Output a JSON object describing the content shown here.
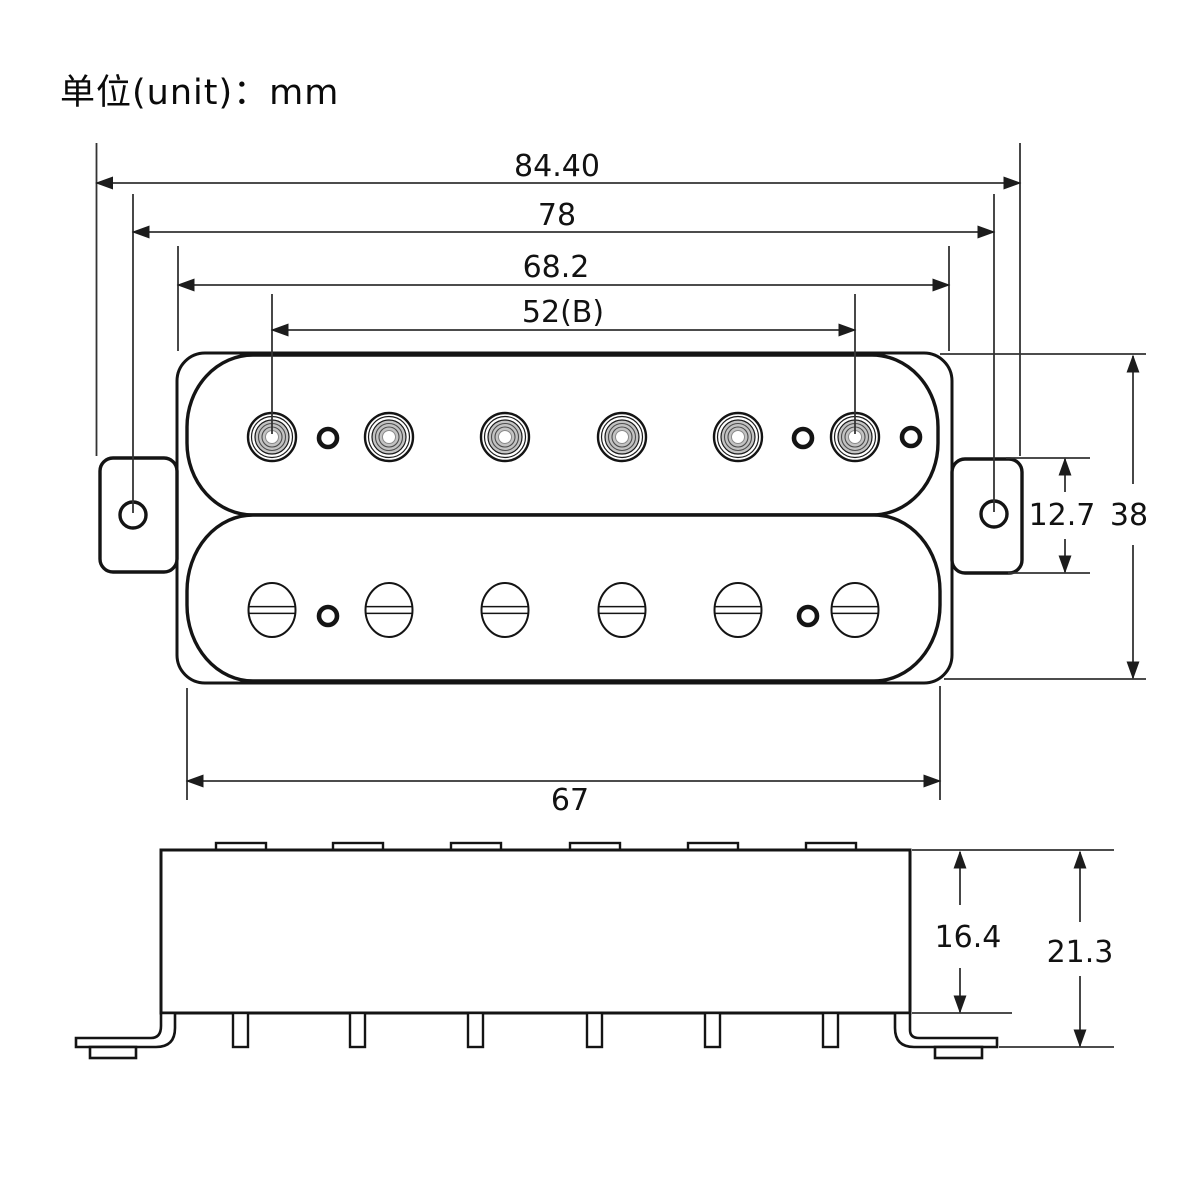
{
  "title": "单位(unit)：mm",
  "unit": "mm",
  "dimensions": {
    "overall_width": "84.40",
    "mounting_hole_span": "78",
    "top_bobbin_width": "68.2",
    "pole_spacing": "52(B)",
    "bottom_bobbin_width": "67",
    "ear_height": "12.7",
    "overall_height": "38",
    "body_height": "16.4",
    "total_height_with_legs": "21.3"
  }
}
